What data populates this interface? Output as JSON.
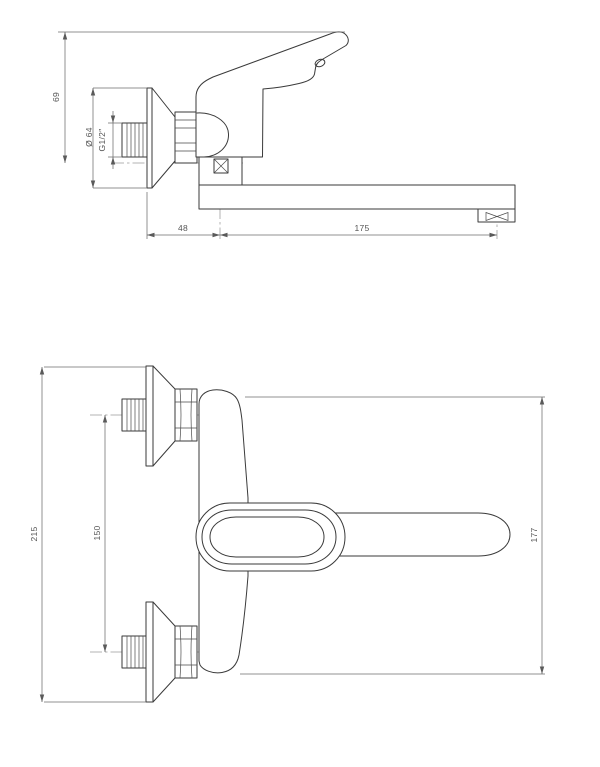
{
  "drawing": {
    "background": "#ffffff",
    "line_color": "#3a3a3a",
    "dimension_color": "#555555"
  },
  "views": {
    "side": {
      "label": "side view",
      "dims": {
        "height": "69",
        "flange_diameter": "Ø 64",
        "thread": "G1/2″",
        "wall_to_axis": "48",
        "spout_reach": "175"
      }
    },
    "plan": {
      "label": "plan view",
      "dims": {
        "overall": "215",
        "centers": "150",
        "length": "177"
      }
    }
  }
}
